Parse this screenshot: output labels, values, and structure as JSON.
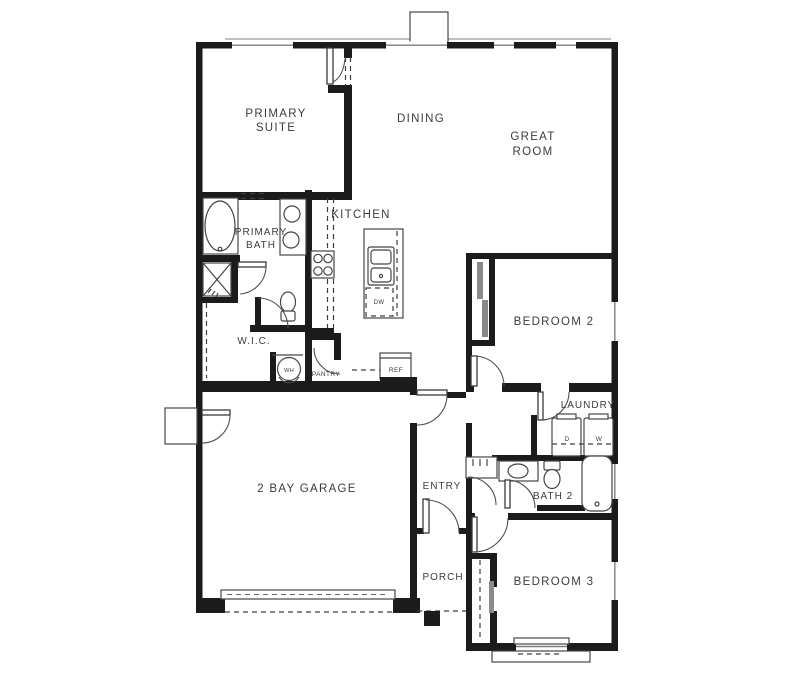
{
  "document": {
    "type": "residential-floor-plan",
    "background": "#ffffff"
  },
  "colors": {
    "wall": "#1b1b1b",
    "line": "#454545",
    "text": "#3c3c3c",
    "background": "#ffffff",
    "slider_gray": "#8a8a8a"
  },
  "labels": {
    "primary_suite": [
      "PRIMARY",
      "SUITE"
    ],
    "dining": [
      "DINING"
    ],
    "great_room": [
      "GREAT",
      "ROOM"
    ],
    "kitchen": [
      "KITCHEN"
    ],
    "primary_bath": [
      "PRIMARY",
      "BATH"
    ],
    "wic": [
      "W.I.C."
    ],
    "wh": [
      "WH"
    ],
    "pantry": [
      "PANTRY"
    ],
    "ref": [
      "REF"
    ],
    "dw": [
      "DW"
    ],
    "bedroom2": [
      "BEDROOM 2"
    ],
    "laundry": [
      "LAUNDRY"
    ],
    "dryer": [
      "D"
    ],
    "washer": [
      "W"
    ],
    "bath2": [
      "BATH 2"
    ],
    "entry": [
      "ENTRY"
    ],
    "garage": [
      "2 BAY GARAGE"
    ],
    "porch": [
      "PORCH"
    ],
    "bedroom3": [
      "BEDROOM 3"
    ]
  }
}
